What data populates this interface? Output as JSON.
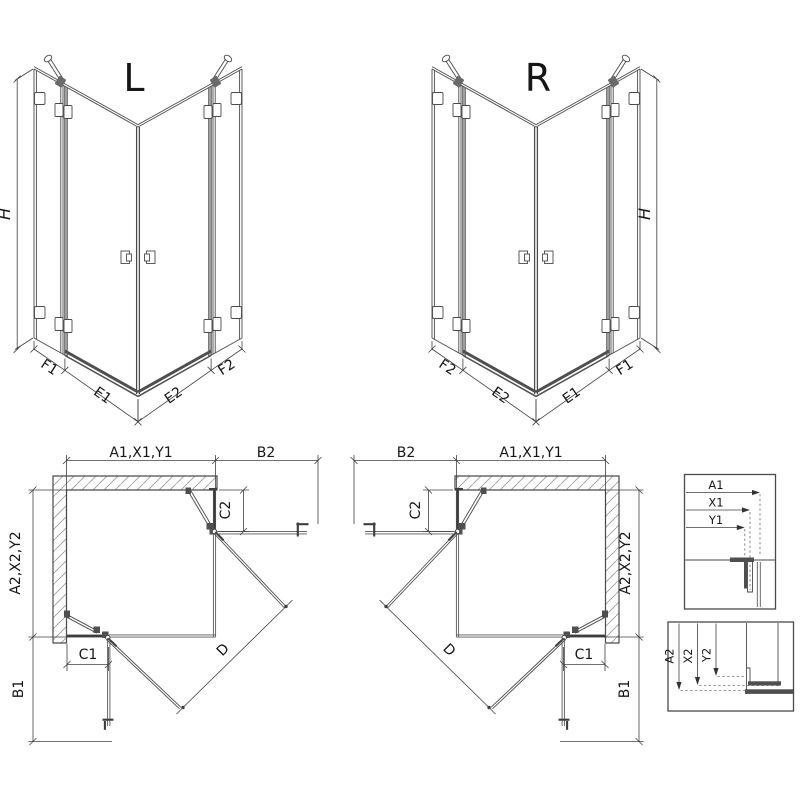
{
  "drawing": {
    "iso_left": {
      "label": "L",
      "height_label": "H",
      "f1": "F1",
      "e1": "E1",
      "e2": "E2",
      "f2": "F2"
    },
    "iso_right": {
      "label": "R",
      "height_label": "H",
      "f1": "F1",
      "e1": "E1",
      "e2": "E2",
      "f2": "F2"
    },
    "plan_left": {
      "width_dim": "A1,X1,Y1",
      "side_panel_dim": "B2",
      "depth_dim": "A2,X2,Y2",
      "bottom_panel_dim": "B1",
      "top_fixed_dim": "C2",
      "bottom_fixed_dim": "C1",
      "door_dim": "D"
    },
    "plan_right": {
      "width_dim": "A1,X1,Y1",
      "side_panel_dim": "B2",
      "depth_dim": "A2,X2,Y2",
      "bottom_panel_dim": "B1",
      "top_fixed_dim": "C2",
      "bottom_fixed_dim": "C1",
      "door_dim": "D"
    },
    "detail_width": {
      "a1": "A1",
      "x1": "X1",
      "y1": "Y1"
    },
    "detail_depth": {
      "a2": "A2",
      "x2": "X2",
      "y2": "Y2"
    },
    "colors": {
      "line": "#4a4a4a",
      "dim": "#3f3f3f",
      "hatch": "#9a9a9a",
      "text": "#161616",
      "background": "#ffffff"
    }
  }
}
